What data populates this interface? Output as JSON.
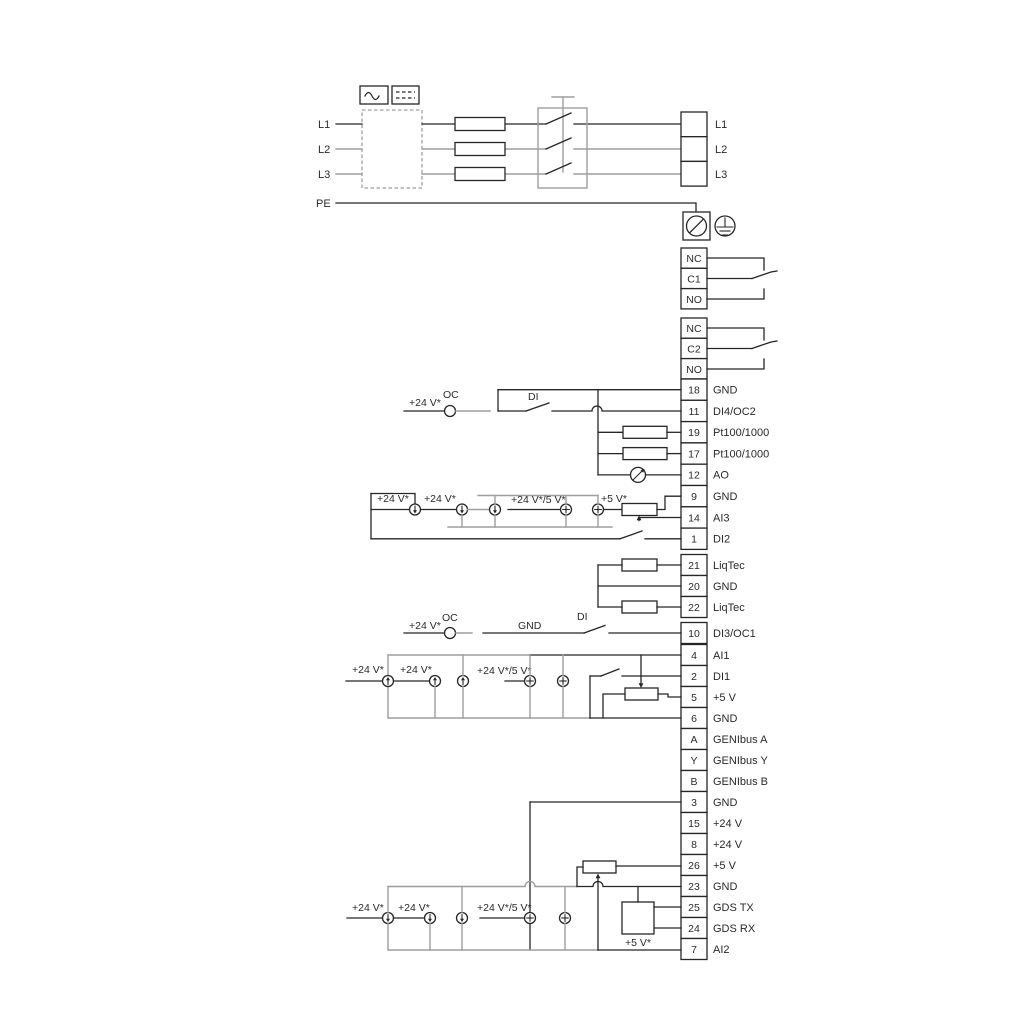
{
  "title": "Pump drive wiring diagram",
  "colors": {
    "ink": "#262626",
    "gray": "#9e9e9e",
    "background": "#ffffff"
  },
  "power": {
    "left": [
      {
        "label": "L1"
      },
      {
        "label": "L2"
      },
      {
        "label": "L3"
      },
      {
        "label": "PE"
      }
    ],
    "right": [
      {
        "label": "L1"
      },
      {
        "label": "L2"
      },
      {
        "label": "L3"
      }
    ]
  },
  "relays": {
    "r1": [
      {
        "label": "NC"
      },
      {
        "label": "C1"
      },
      {
        "label": "NO"
      }
    ],
    "r2": [
      {
        "label": "NC"
      },
      {
        "label": "C2"
      },
      {
        "label": "NO"
      }
    ]
  },
  "terminals": {
    "io1": [
      {
        "n": "18",
        "label": "GND"
      },
      {
        "n": "11",
        "label": "DI4/OC2"
      },
      {
        "n": "19",
        "label": "Pt100/1000"
      },
      {
        "n": "17",
        "label": "Pt100/1000"
      },
      {
        "n": "12",
        "label": "AO"
      },
      {
        "n": "9",
        "label": "GND"
      },
      {
        "n": "14",
        "label": "AI3"
      },
      {
        "n": "1",
        "label": "DI2"
      }
    ],
    "liqtec": [
      {
        "n": "21",
        "label": "LiqTec"
      },
      {
        "n": "20",
        "label": "GND"
      },
      {
        "n": "22",
        "label": "LiqTec"
      }
    ],
    "di3": [
      {
        "n": "10",
        "label": "DI3/OC1"
      }
    ],
    "io2": [
      {
        "n": "4",
        "label": "AI1"
      },
      {
        "n": "2",
        "label": "DI1"
      },
      {
        "n": "5",
        "label": "+5 V"
      },
      {
        "n": "6",
        "label": "GND"
      },
      {
        "n": "A",
        "label": "GENIbus A"
      },
      {
        "n": "Y",
        "label": "GENIbus Y"
      },
      {
        "n": "B",
        "label": "GENIbus B"
      }
    ],
    "io3": [
      {
        "n": "3",
        "label": "GND"
      },
      {
        "n": "15",
        "label": "+24 V"
      },
      {
        "n": "8",
        "label": "+24 V"
      },
      {
        "n": "26",
        "label": "+5 V"
      },
      {
        "n": "23",
        "label": "GND"
      },
      {
        "n": "25",
        "label": "GDS TX"
      },
      {
        "n": "24",
        "label": "GDS RX"
      },
      {
        "n": "7",
        "label": "AI2"
      }
    ]
  },
  "annotations": {
    "di4_row": {
      "v24": "+24 V*",
      "oc": "OC",
      "di": "DI"
    },
    "cluster_a": {
      "v24_1": "+24 V*",
      "v24_2": "+24 V*",
      "v24_5v": "+24 V*/5 V*",
      "v5": "+5 V*"
    },
    "di3_row": {
      "v24": "+24 V*",
      "oc": "OC",
      "gnd": "GND",
      "di": "DI"
    },
    "cluster_b": {
      "v24_1": "+24 V*",
      "v24_2": "+24 V*",
      "v24_5v": "+24 V*/5 V*"
    },
    "cluster_c": {
      "v24_1": "+24 V*",
      "v24_2": "+24 V*",
      "v24_5v": "+24 V*/5 V*",
      "v5": "+5 V*"
    }
  }
}
